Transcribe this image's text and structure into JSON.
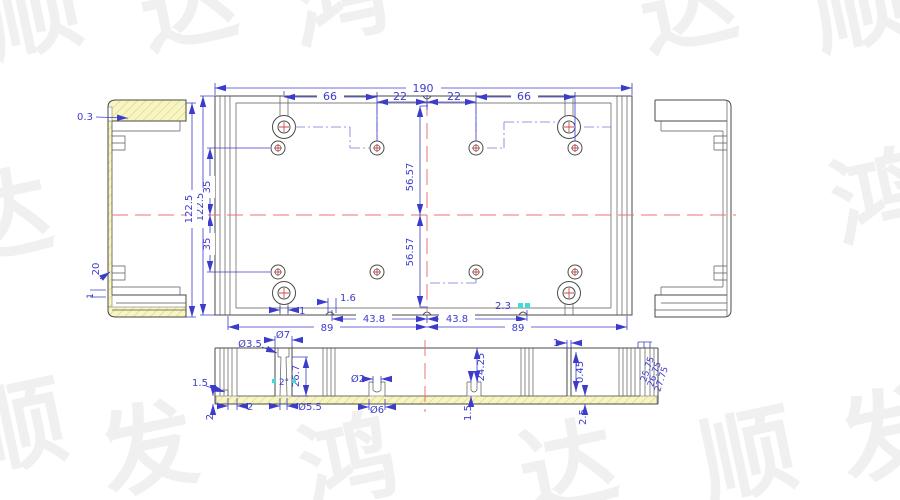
{
  "drawing": {
    "colors": {
      "outline": "#4a4a48",
      "dimension": "#3c3ccc",
      "centerline": "#e87474",
      "phantom_line": "#7878d8",
      "hatch_fill": "#f7f5c4",
      "hatch_line": "#d8d066",
      "highlight": "#45d8d8"
    },
    "watermark": {
      "chars": [
        "顺",
        "达",
        "鸿",
        "发"
      ]
    },
    "plan_view": {
      "overall_width": "190",
      "boss_span_left": "66",
      "boss_span_right": "66",
      "center_offset_left": "22",
      "center_offset_right": "22",
      "overall_height": "122.5",
      "hole_offset_upper": "35",
      "hole_offset_lower": "35",
      "diagonal_upper": "56.57",
      "diagonal_lower": "56.57",
      "stem_width": "1",
      "notch_left": "1.6",
      "notch_right": "2.3",
      "half_span_left": "43.8",
      "half_span_right": "43.8",
      "base_span_left": "89",
      "base_span_right": "89"
    },
    "side_view": {
      "lip_thickness": "0.3",
      "overall_height": "122.5",
      "clip_offset": "20",
      "wall_offset": "1"
    },
    "section_view": {
      "bore_small": "Ø3.5",
      "counterbore": "Ø7",
      "boss_depth": "26.7",
      "draft_angle": "2°",
      "bore_large": "Ø5.5",
      "channel_bore": "Ø2",
      "channel_od": "Ø6",
      "rib_height": "24.25",
      "channel_height": "1.5",
      "wall_thickness": "1",
      "wall_gap": "0.45",
      "floor_thickness": "2.5",
      "edge_notch": "1.5",
      "edge_height": "2",
      "edge_width": "2",
      "stack_height_1": "25.75",
      "stack_height_2": "26.75",
      "stack_height_3": "27.75"
    }
  }
}
